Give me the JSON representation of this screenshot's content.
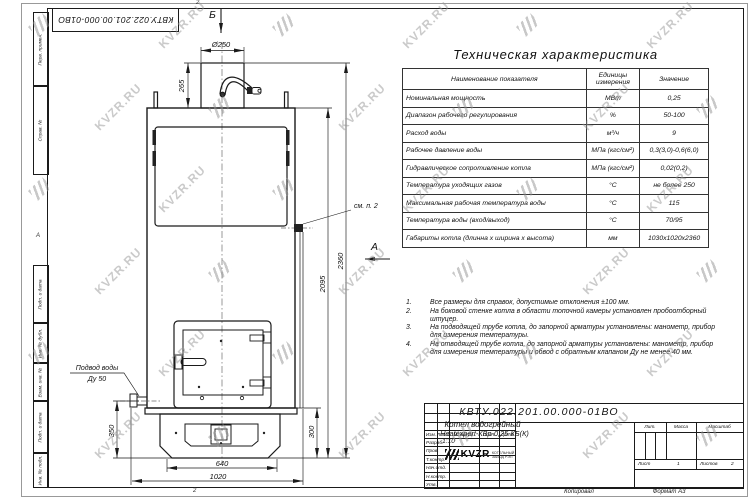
{
  "page": {
    "corner_ref": "КВТУ.022.201.00.000-01ВО",
    "zone_top": "2",
    "zone_bottom": "2",
    "zone_left": "А",
    "footer_copied": "Копировал",
    "footer_format": "Формат А3"
  },
  "watermark": {
    "text": "KVZR.RU"
  },
  "margin_labels": [
    "Перв. примен.",
    "Справ. №",
    "Подп. и дата",
    "Инв. № дубл.",
    "Взам. инв. №",
    "Подп. и дата",
    "Инв. № подл."
  ],
  "tech_table": {
    "title": "Техническая характеристика",
    "headers": [
      "Наименование показателя",
      "Единицы измерения",
      "Значение"
    ],
    "rows": [
      [
        "Номинальная мощность",
        "МВт",
        "0,25"
      ],
      [
        "Диапазон рабочего регулирования",
        "%",
        "50-100"
      ],
      [
        "Расход воды",
        "м³/ч",
        "9"
      ],
      [
        "Рабочее давление воды",
        "МПа (кгс/см²)",
        "0,3(3,0)-0,6(6,0)"
      ],
      [
        "Гидравлическое сопротивление котла",
        "МПа (кгс/см²)",
        "0,02(0,2)"
      ],
      [
        "Температура уходящих газов",
        "°С",
        "не более 250"
      ],
      [
        "Максимальная рабочая температура воды",
        "°С",
        "115"
      ],
      [
        "Температура воды (вход/выход)",
        "°С",
        "70/95"
      ],
      [
        "Габариты котла (длинна х ширина х высота)",
        "мм",
        "1030х1020х2360"
      ]
    ]
  },
  "notes": [
    "Все размеры для справок, допустимые отклонения ±100 мм.",
    "На боковой стенке котла в области топочной камеры установлен пробоотборный штуцер.",
    "На подводящей трубе котла, до запорной арматуры установлены: манометр, прибор для измерения температуры.",
    "На отводящей трубе котла, до запорной арматуры установлены: манометр, прибор для измерения температуры и обвод с обратным клапаном Ду не менее 40 мм."
  ],
  "drawing": {
    "dims": {
      "d250": "Ø250",
      "h265": "265",
      "h2360": "2360",
      "h2095": "2095",
      "h350": "350",
      "h300": "300",
      "w640": "640",
      "w1020": "1020"
    },
    "labels": {
      "view_b": "Б",
      "view_a": "А",
      "see_note": "см. п. 2",
      "water_1": "Подвод воды",
      "water_2": "Ду 50"
    }
  },
  "title_block": {
    "doc_number": "КВТУ.022.201.00.000-01ВО",
    "name_line1": "Котел водогрейный",
    "name_line2": "Heatexpert-КВр-0,25-КБ(К)",
    "cols": {
      "izm": "Изм.",
      "list": "Лист",
      "doc": "№ докум.",
      "podp": "Подп.",
      "data": "Дата"
    },
    "rows": [
      "Разраб.",
      "Пров.",
      "Т.контр.",
      "Нач.отд.",
      "Н.контр.",
      "Утв."
    ],
    "lit": "Лит.",
    "mass": "Масса",
    "scale_label": "Масштаб",
    "scale": "1:10",
    "sheet_label": "Лист",
    "sheet": "1",
    "sheets_label": "Листов",
    "sheets": "2",
    "org_name": "KVZR",
    "org_line1": "КОТЕЛЬНЫЙ",
    "org_line2": "ЗАВОД РЭП"
  }
}
